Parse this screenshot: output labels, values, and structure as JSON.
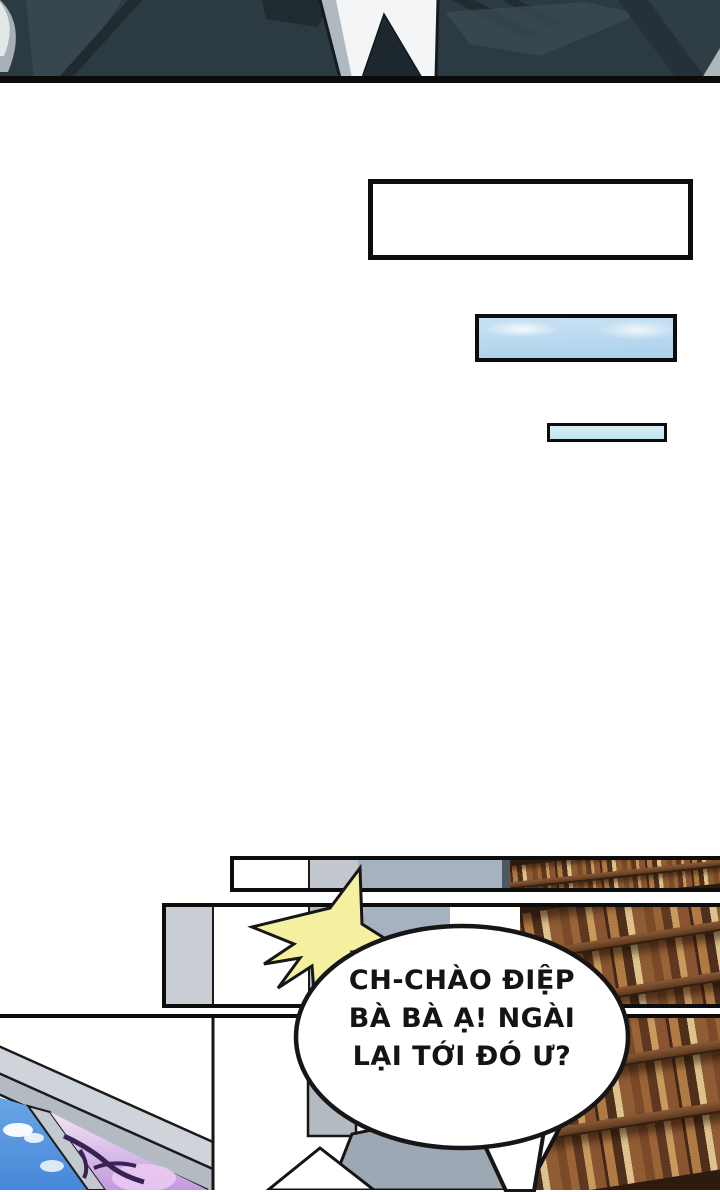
{
  "speech_bubble": {
    "lines": [
      "CH-CHÀO ĐIỆP",
      "BÀ BÀ Ạ! NGÀI",
      "LẠI TỚI ĐÓ Ư?"
    ]
  },
  "icons": {
    "starburst": "comic-shout-burst"
  },
  "palette": {
    "outline": "#0d0d0d",
    "suit_dark": "#2c3a42",
    "suit_shadow": "#1f2a31",
    "suit_highlight": "#3c4b53",
    "shirt": "#f3f5f6",
    "tie": "#1d272e",
    "flashback_sky": "#9cc9ee",
    "flashback_sky_light": "#c0e5f0",
    "window_sky": "#4688d8",
    "glass_purple": "#c29ade",
    "branches": "#3a2153",
    "pillar": "#b3bac2",
    "wall_strip": "#c8ced4",
    "steel_band": "#a7b2c0",
    "desk": "#9da8b5",
    "starburst": "#f5f1a1",
    "shelf_bg": "#2e1b10",
    "shelf_board": "#8a5a35",
    "book_a": "#7b4a28",
    "book_b": "#9a6436",
    "book_c": "#5e3820",
    "book_d": "#c79a5e",
    "book_e": "#b07a42",
    "book_f": "#dec28c"
  }
}
